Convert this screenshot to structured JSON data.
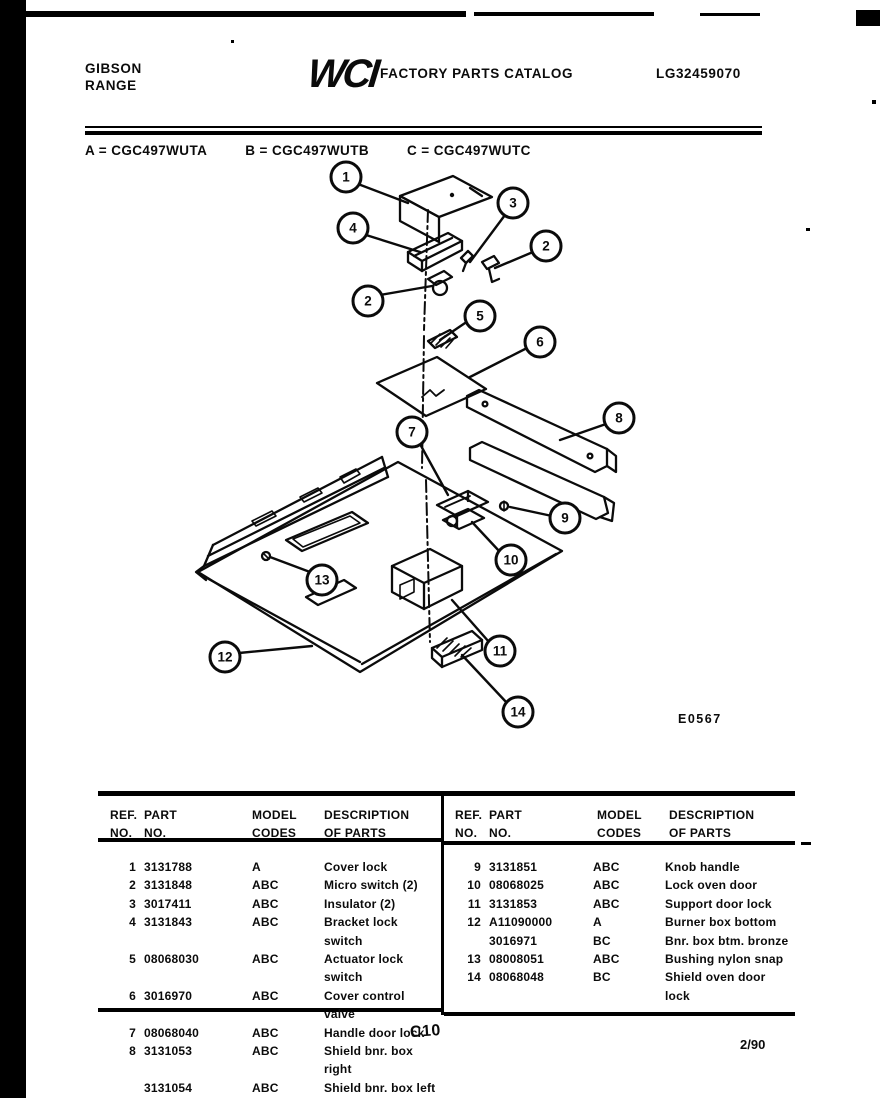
{
  "header": {
    "brand_line1": "GIBSON",
    "brand_line2": "RANGE",
    "logo": "WCI",
    "catalog_title": "FACTORY PARTS CATALOG",
    "doc_number": "LG32459070"
  },
  "model_line": {
    "a": "A = CGC497WUTA",
    "b": "B = CGC497WUTB",
    "c": "C = CGC497WUTC"
  },
  "diagram": {
    "figure_code": "E0567",
    "callouts": [
      {
        "n": "1",
        "x": 346,
        "y": 177
      },
      {
        "n": "4",
        "x": 353,
        "y": 228
      },
      {
        "n": "3",
        "x": 513,
        "y": 203
      },
      {
        "n": "2",
        "x": 546,
        "y": 246
      },
      {
        "n": "2",
        "x": 368,
        "y": 301
      },
      {
        "n": "5",
        "x": 480,
        "y": 316
      },
      {
        "n": "6",
        "x": 540,
        "y": 342
      },
      {
        "n": "8",
        "x": 619,
        "y": 418
      },
      {
        "n": "7",
        "x": 412,
        "y": 432
      },
      {
        "n": "9",
        "x": 565,
        "y": 518
      },
      {
        "n": "10",
        "x": 511,
        "y": 560
      },
      {
        "n": "13",
        "x": 322,
        "y": 580
      },
      {
        "n": "11",
        "x": 500,
        "y": 651
      },
      {
        "n": "12",
        "x": 225,
        "y": 657
      },
      {
        "n": "14",
        "x": 518,
        "y": 712
      }
    ]
  },
  "parts_table": {
    "headers": {
      "ref1": "REF.",
      "ref2": "NO.",
      "part1": "PART",
      "part2": "NO.",
      "model1": "MODEL",
      "model2": "CODES",
      "desc1": "DESCRIPTION",
      "desc2": "OF PARTS"
    },
    "left_rows": [
      {
        "ref": "1",
        "part": "3131788",
        "codes": "A",
        "desc": "Cover lock"
      },
      {
        "ref": "2",
        "part": "3131848",
        "codes": "ABC",
        "desc": "Micro switch (2)"
      },
      {
        "ref": "3",
        "part": "3017411",
        "codes": "ABC",
        "desc": "Insulator (2)"
      },
      {
        "ref": "4",
        "part": "3131843",
        "codes": "ABC",
        "desc": "Bracket lock switch"
      },
      {
        "ref": "5",
        "part": "08068030",
        "codes": "ABC",
        "desc": "Actuator lock switch"
      },
      {
        "ref": "6",
        "part": "3016970",
        "codes": "ABC",
        "desc": "Cover control valve"
      },
      {
        "ref": "7",
        "part": "08068040",
        "codes": "ABC",
        "desc": "Handle door lock"
      },
      {
        "ref": "8",
        "part": "3131053",
        "codes": "ABC",
        "desc": "Shield bnr. box right"
      },
      {
        "ref": "",
        "part": "3131054",
        "codes": "ABC",
        "desc": "Shield bnr. box left"
      }
    ],
    "right_rows": [
      {
        "ref": "9",
        "part": "3131851",
        "codes": "ABC",
        "desc": "Knob handle"
      },
      {
        "ref": "10",
        "part": "08068025",
        "codes": "ABC",
        "desc": "Lock oven door"
      },
      {
        "ref": "11",
        "part": "3131853",
        "codes": "ABC",
        "desc": "Support door lock"
      },
      {
        "ref": "12",
        "part": "A11090000",
        "codes": "A",
        "desc": "Burner box bottom"
      },
      {
        "ref": "",
        "part": "3016971",
        "codes": "BC",
        "desc": "Bnr. box btm. bronze"
      },
      {
        "ref": "13",
        "part": "08008051",
        "codes": "ABC",
        "desc": "Bushing nylon snap"
      },
      {
        "ref": "14",
        "part": "08068048",
        "codes": "BC",
        "desc": "Shield oven door lock"
      }
    ]
  },
  "footer": {
    "page_code": "C10",
    "date_code": "2/90"
  }
}
